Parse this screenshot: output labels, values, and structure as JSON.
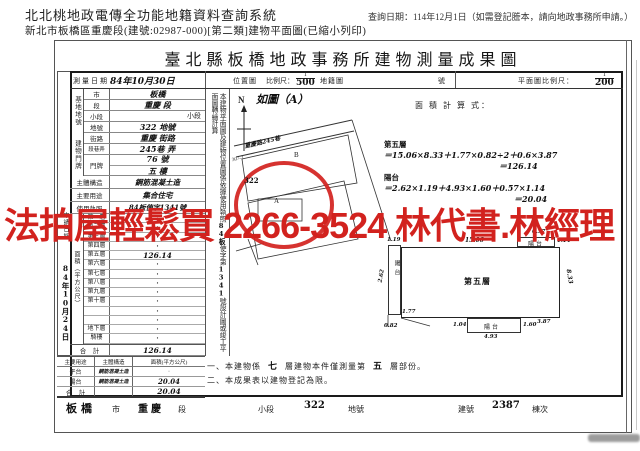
{
  "header": {
    "system_title": "北北桃地政電傳全功能地籍資料查詢系統",
    "subtitle": "新北市板橋區重慶段(建號:02987-000)[第二類]建物平面圖(已縮小列印)",
    "query_date": "查詢日期：114年12月1日（如需登記謄本，請向地政事務所申請。）"
  },
  "doc": {
    "title": "臺北縣板橋地政事務所建物測量成果圖",
    "survey": {
      "label": "測量日期",
      "value": "84年10月30日"
    },
    "loc_header": {
      "map_label": "位置圖",
      "scale_label": "比例尺：",
      "num": "1",
      "den": "500",
      "cad": "地籍圖",
      "no_label": "號"
    },
    "plan_header": {
      "label": "平面圖比例尺：",
      "num": "1",
      "den": "200"
    },
    "left": {
      "site_group": "基地地號",
      "site_rows": [
        {
          "label": "市",
          "value": "板橋"
        },
        {
          "label": "段",
          "value": "重慶 段"
        },
        {
          "label": "小段",
          "value": "小段"
        },
        {
          "label": "地號",
          "value": "322 地號"
        }
      ],
      "bldg_group": "建物門牌",
      "bldg_rows": [
        {
          "label": "街路",
          "value": "重慶 街路"
        },
        {
          "label": "段巷弄",
          "value": "245巷 弄"
        }
      ],
      "door_label": "門牌",
      "door_line1": "76 號",
      "door_line2": "五 樓",
      "structure": {
        "label": "主體構造",
        "value": "鋼筋混凝土造"
      },
      "usage": {
        "label": "主要用途",
        "value": "集合住宅"
      },
      "license": {
        "label": "使用執照",
        "value": "84板使字1341號"
      },
      "area_group": "面積（平方公尺）",
      "area_rows": [
        {
          "label": "第一層",
          "value": "·"
        },
        {
          "label": "第二層",
          "value": "·"
        },
        {
          "label": "第三層",
          "value": "·"
        },
        {
          "label": "第四層",
          "value": "·"
        },
        {
          "label": "第五層",
          "value": "126.14"
        },
        {
          "label": "第六層",
          "value": "·"
        },
        {
          "label": "第七層",
          "value": "·"
        },
        {
          "label": "第八層",
          "value": "·"
        },
        {
          "label": "第九層",
          "value": "·"
        },
        {
          "label": "第十層",
          "value": "·"
        },
        {
          "label": "",
          "value": "·"
        },
        {
          "label": "",
          "value": "·"
        },
        {
          "label": "地下層",
          "value": "·"
        },
        {
          "label": "騎樓",
          "value": "·"
        }
      ],
      "total": {
        "label": "合　計",
        "value": "126.14"
      },
      "annex": {
        "headers": [
          "主要用途",
          "主體構造",
          "面積(平方公尺)"
        ],
        "rows": [
          [
            "平台",
            "鋼筋混凝土造",
            "·"
          ],
          [
            "陽台",
            "鋼筋混凝土造",
            "20.04"
          ]
        ],
        "total_label": "合　計",
        "total_value": "20.04"
      },
      "apply": {
        "label": "申請日期",
        "value": "84年10月24日"
      }
    },
    "strip": {
      "pre": "本建物平面圖及建物位置圖係依據使用執照",
      "hand1": "84板",
      "mid": "使字第",
      "hand2": "1341",
      "post": "號設計圖或竣工平面圖轉繪計算"
    },
    "map": {
      "north": "N",
      "figure": "如圖（A）",
      "street": "重慶路245巷",
      "lot1": "307-2",
      "lot2": "322",
      "parcel_a": "A",
      "parcel_b": "B"
    },
    "calc": {
      "label": "面 積 計 算 式：",
      "l1": "第五層",
      "l2": "＝15.06×8.33＋1.77×0.82÷2＋0.6×3.87",
      "l3": "＝126.14",
      "l4": "陽台",
      "l5": "＝2.62×1.19＋4.93×1.60＋0.57×1.14",
      "l6": "＝20.04"
    },
    "plan": {
      "room": "第五層",
      "balcony_left": "陽台",
      "balcony_top": "陽台",
      "balcony_bottom": "陽台",
      "dims": {
        "top": "15.06",
        "right": "8.33",
        "left_w": "1.19",
        "left_h": "2.62",
        "bl1": "1.77",
        "bl2": "0.82",
        "tr_w": "0.57",
        "tr_h": "1.14",
        "b_w": "4.93",
        "b_h": "1.60",
        "b_l": "1.04",
        "br": "3.87"
      }
    },
    "notes": {
      "n1a": "一、本建物係",
      "n1h1": "七",
      "n1b": "層建物本件僅測量第",
      "n1h2": "五",
      "n1c": "層部份。",
      "n2": "二、本成果表以建物登記為限。"
    },
    "bottom": {
      "city_hand": "板橋",
      "city": "市",
      "sec_hand": "重慶",
      "sec": "段",
      "subsec": "小段",
      "lot_hand": "322",
      "lot": "地號",
      "bno": "建號",
      "bno_hand": "2387",
      "unit": "棟次"
    }
  },
  "watermark": {
    "text": "法拍屋輕鬆買 2266-3524 林代書.林經理",
    "color": "#d2221e"
  }
}
